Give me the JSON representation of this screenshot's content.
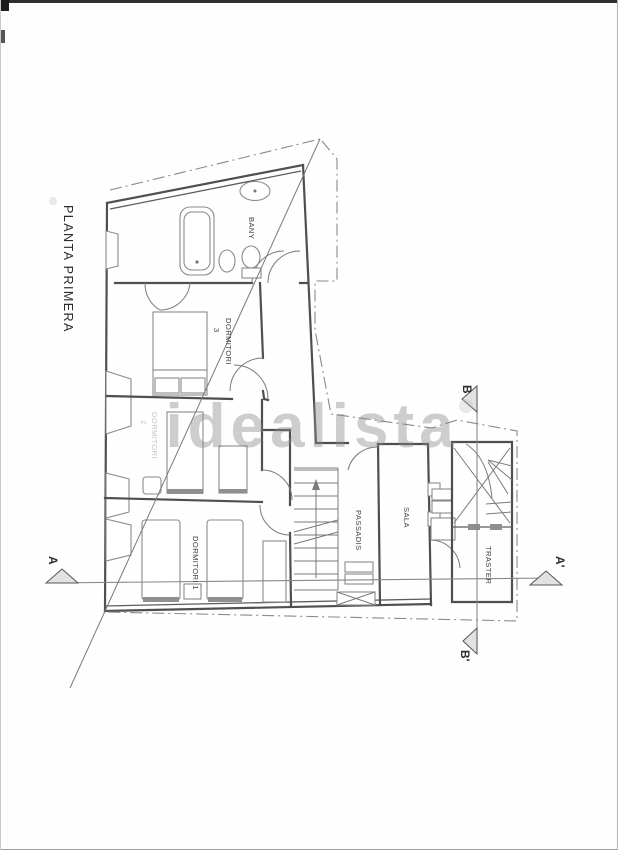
{
  "document": {
    "title": "PLANTA PRIMERA"
  },
  "watermark": {
    "text": "idealista"
  },
  "rooms": {
    "bany": {
      "label": "BANY"
    },
    "dormitori3": {
      "label": "DORMITORI",
      "number": "3"
    },
    "dormitori2": {
      "label": "DORMITORI",
      "number": "2"
    },
    "dormitori1": {
      "label": "DORMITORI 1"
    },
    "passadis": {
      "label": "PASSADIS"
    },
    "sala": {
      "label": "SALA"
    },
    "traster": {
      "label": "TRASTER"
    }
  },
  "sections": {
    "a": {
      "start": "A",
      "end": "A'"
    },
    "b": {
      "start": "B",
      "end": "B'"
    }
  },
  "colors": {
    "ink": "#3f3f3f",
    "wall": "#4f4f4f",
    "thin_line": "#8a8a8a",
    "watermark": "#8a8a8a",
    "paper": "#fefefe"
  }
}
